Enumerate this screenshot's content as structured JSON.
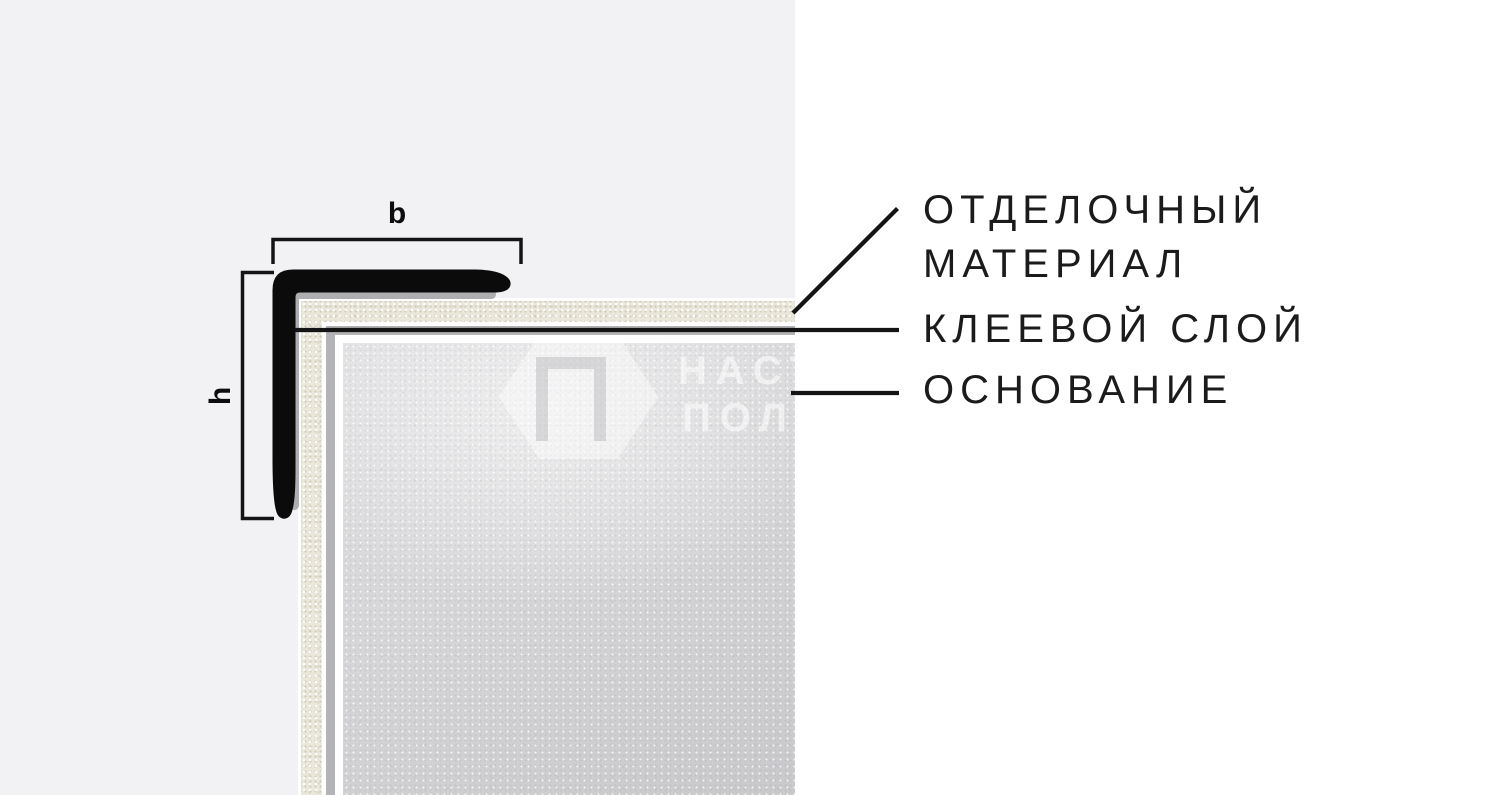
{
  "diagram": {
    "type": "corner-profile-cross-section",
    "dimensions": {
      "width_label": "b",
      "height_label": "h"
    },
    "callouts": {
      "finish": {
        "line1": "ОТДЕЛОЧНЫЙ",
        "line2": "МАТЕРИАЛ"
      },
      "adhesive": {
        "line1": "КЛЕЕВОЙ СЛОЙ"
      },
      "base": {
        "line1": "ОСНОВАНИЕ"
      }
    },
    "watermark": {
      "line1": "НАСТ",
      "line2": "ПОЛ"
    },
    "colors": {
      "panel_bg": "#f2f2f4",
      "page_bg": "#ffffff",
      "profile": "#0b0b0b",
      "profile_shadow": "#aeaeb1",
      "finish_layer": "#eae7db",
      "adhesive_layer": "#b4b4b7",
      "base_layer": "#d9d9db",
      "linework": "#141414"
    }
  }
}
